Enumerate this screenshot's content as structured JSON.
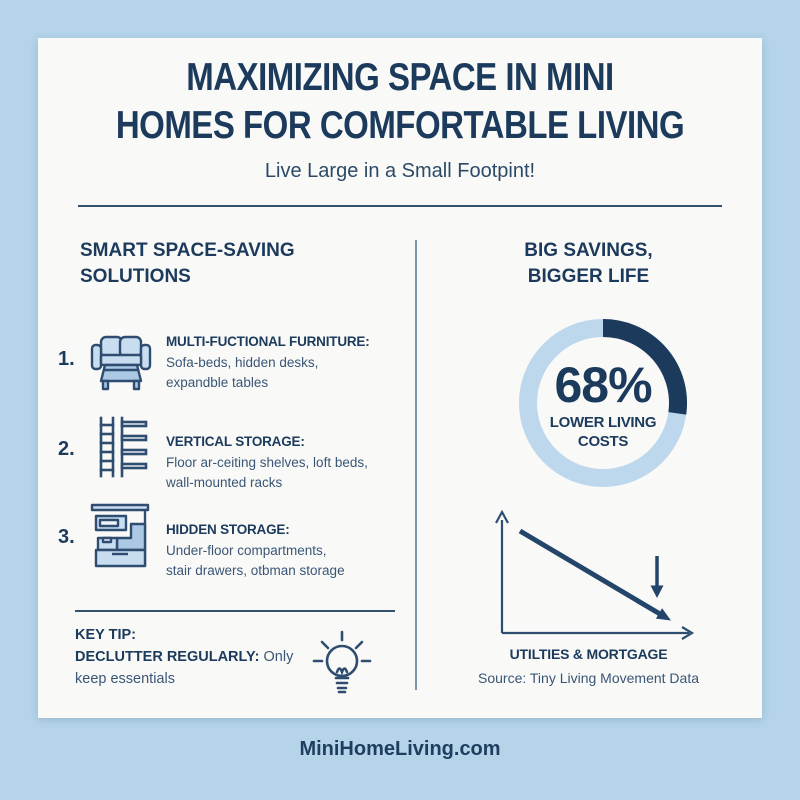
{
  "infographic": {
    "title_line1": "MAXIMIZING SPACE IN MINI",
    "title_line2": "HOMES FOR COMFORTABLE LIVING",
    "subtitle": "Live Large in a Small Footpint!",
    "footer": "MiniHomeLiving.com"
  },
  "left_column": {
    "heading_line1": "SMART SPACE-SAVING",
    "heading_line2": "SOLUTIONS",
    "items": [
      {
        "number": "1.",
        "icon": "sofa-bed-icon",
        "title": "MULTI-FUCTIONAL FURNITURE:",
        "desc_line1": "Sofa-beds, hidden desks,",
        "desc_line2": "expandble tables"
      },
      {
        "number": "2.",
        "icon": "vertical-shelves-icon",
        "title": "VERTICAL STORAGE:",
        "desc_line1": "Floor ar-ceiting shelves, loft beds,",
        "desc_line2": "wall-mounted racks"
      },
      {
        "number": "3.",
        "icon": "stair-storage-icon",
        "title": "HIDDEN STORAGE:",
        "desc_line1": "Under-floor compartments,",
        "desc_line2": "stair drawers, otbman storage"
      }
    ],
    "key_tip": {
      "label": "KEY TIP:",
      "emphasis": "DECLUTTER REGULARLY:",
      "rest_line1": " Only",
      "rest_line2": "keep essentials",
      "icon": "lightbulb-icon"
    }
  },
  "right_column": {
    "heading_line1": "BIG SAVINGS,",
    "heading_line2": "BIGGER LIFE",
    "donut": {
      "value": "68%",
      "label_line1": "LOWER LIVING",
      "label_line2": "COSTS"
    },
    "trend": {
      "axis_label": "UTILTIES & MORTGAGE",
      "source": "Source: Tiny Living Movement Data"
    }
  },
  "chart_data": [
    {
      "type": "pie",
      "subtype": "donut",
      "title": "BIG SAVINGS, BIGGER LIFE",
      "categories": [
        "Lower living costs",
        "Remainder"
      ],
      "values": [
        68,
        32
      ],
      "center_label": "68% LOWER LIVING COSTS",
      "shown_arc_degrees": 98,
      "arc_start": "12-o-clock-clockwise",
      "colors": {
        "arc": "#1b3a5c",
        "ring": "#bdd7ec"
      },
      "legend": "none"
    },
    {
      "type": "line",
      "title": "UTILTIES & MORTGAGE",
      "x": [
        "start",
        "end"
      ],
      "y": [
        100,
        20
      ],
      "trend": "decreasing",
      "annotations": [
        "down-arrow near line end",
        "arrowhead on line end"
      ],
      "axis_ticks": "none",
      "grid": false,
      "source": "Source: Tiny Living Movement Data"
    }
  ],
  "colors": {
    "background": "#b5d4ea",
    "card": "#f9f9f7",
    "navy": "#1c3a5c",
    "body_text": "#3a5676",
    "icon_fill": "#c8ddf0",
    "icon_fill_dark": "#abc8e4",
    "icon_stroke": "#2e4d70",
    "donut_ring": "#bdd7ec",
    "donut_arc": "#1b3a5c",
    "divider": "#7d95aa"
  }
}
